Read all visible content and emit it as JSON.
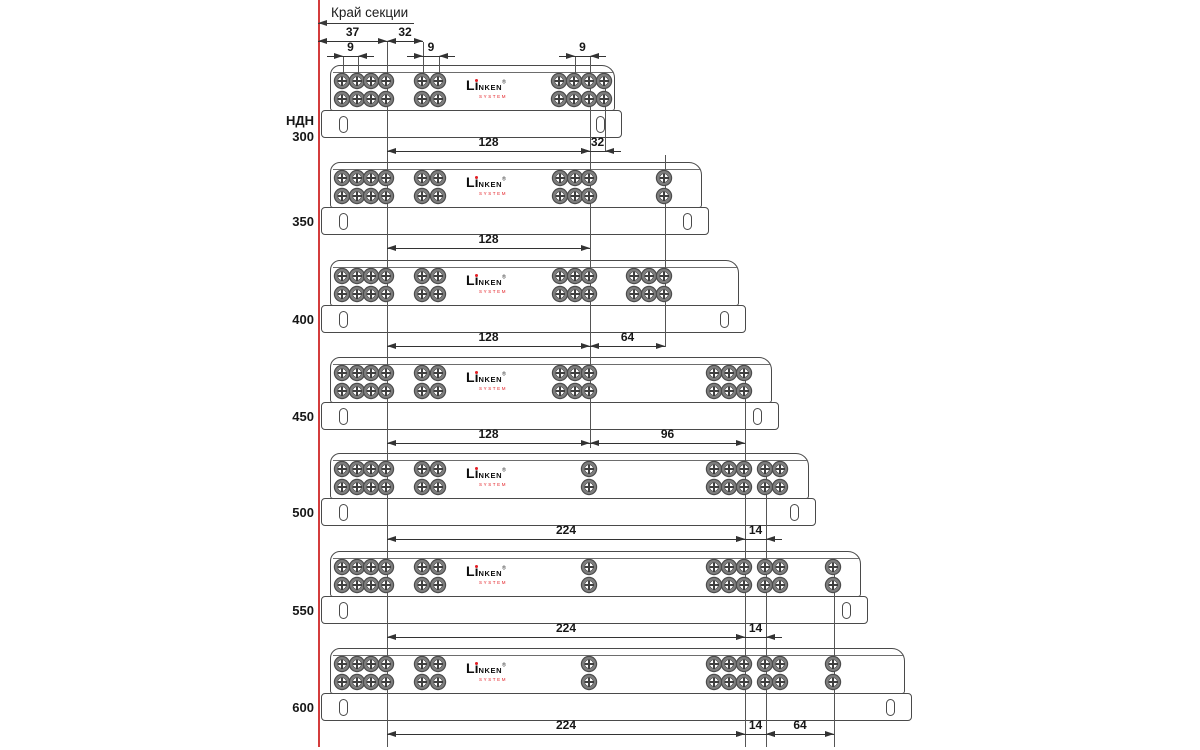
{
  "diagram": {
    "edge_section_label": "Край секции",
    "series_prefix": "НДН",
    "logo": {
      "l": "L",
      "i": "i",
      "rest": "NKEN",
      "reg": "®",
      "sub": "SYSTEM"
    },
    "colors": {
      "line": "#4a4a4a",
      "dim_line": "#333333",
      "text": "#171717",
      "guide_red": "#d43c3c",
      "logo_red": "#e31e24",
      "background": "#ffffff"
    },
    "guide_x": 318,
    "leader": {
      "y": 23,
      "x1": 318,
      "x2": 414
    },
    "top_dims": [
      {
        "label": "37",
        "x1": 318,
        "x2": 387,
        "y": 42
      },
      {
        "label": "32",
        "x1": 387,
        "x2": 423,
        "y": 42
      },
      {
        "label": "9",
        "x1": 343,
        "x2": 358,
        "y": 57,
        "outside": true
      },
      {
        "label": "9",
        "x1": 423,
        "x2": 439,
        "y": 57,
        "outside": true
      },
      {
        "label": "9",
        "x1": 575,
        "x2": 590,
        "y": 57,
        "outside": true
      }
    ],
    "construction_lines": [
      {
        "x": 387,
        "y1": 42,
        "y2": 747
      },
      {
        "x": 590,
        "y1": 57,
        "y2": 448
      },
      {
        "x": 665,
        "y1": 155,
        "y2": 347
      },
      {
        "x": 745,
        "y1": 368,
        "y2": 747
      },
      {
        "x": 766,
        "y1": 462,
        "y2": 747
      },
      {
        "x": 834,
        "y1": 560,
        "y2": 747
      }
    ],
    "extension_lines": [
      {
        "x": 343,
        "y1": 57,
        "y2": 80
      },
      {
        "x": 358,
        "y1": 57,
        "y2": 80
      },
      {
        "x": 423,
        "y1": 42,
        "y2": 80
      },
      {
        "x": 439,
        "y1": 57,
        "y2": 80
      },
      {
        "x": 575,
        "y1": 57,
        "y2": 80
      },
      {
        "x": 605,
        "y1": 78,
        "y2": 152
      }
    ],
    "slides": [
      {
        "size": "300",
        "show_prefix": true,
        "top": 65,
        "left": 330,
        "right": 616,
        "hole_cols": [
          343,
          358,
          372,
          387,
          423,
          439,
          560,
          575,
          590,
          605
        ],
        "dims": [
          {
            "label": "128",
            "x1": 387,
            "x2": 590
          },
          {
            "label": "32",
            "x1": 590,
            "x2": 605,
            "outside": true
          }
        ]
      },
      {
        "size": "350",
        "show_prefix": false,
        "top": 162,
        "left": 330,
        "right": 703,
        "hole_cols": [
          343,
          358,
          372,
          387,
          423,
          439,
          561,
          576,
          590,
          665
        ],
        "dims": [
          {
            "label": "128",
            "x1": 387,
            "x2": 590
          }
        ]
      },
      {
        "size": "400",
        "show_prefix": false,
        "top": 260,
        "left": 330,
        "right": 740,
        "hole_cols": [
          343,
          358,
          372,
          387,
          423,
          439,
          561,
          576,
          590,
          635,
          650,
          665
        ],
        "dims": [
          {
            "label": "128",
            "x1": 387,
            "x2": 590
          },
          {
            "label": "64",
            "x1": 590,
            "x2": 665
          }
        ]
      },
      {
        "size": "450",
        "show_prefix": false,
        "top": 357,
        "left": 330,
        "right": 773,
        "hole_cols": [
          343,
          358,
          372,
          387,
          423,
          439,
          561,
          576,
          590,
          715,
          730,
          745
        ],
        "dims": [
          {
            "label": "128",
            "x1": 387,
            "x2": 590
          },
          {
            "label": "96",
            "x1": 590,
            "x2": 745
          }
        ]
      },
      {
        "size": "500",
        "show_prefix": false,
        "top": 453,
        "left": 330,
        "right": 810,
        "hole_cols": [
          343,
          358,
          372,
          387,
          423,
          439,
          590,
          715,
          730,
          745,
          766,
          781
        ],
        "dims": [
          {
            "label": "224",
            "x1": 387,
            "x2": 745
          },
          {
            "label": "14",
            "x1": 745,
            "x2": 766,
            "outside": true
          }
        ]
      },
      {
        "size": "550",
        "show_prefix": false,
        "top": 551,
        "left": 330,
        "right": 862,
        "hole_cols": [
          343,
          358,
          372,
          387,
          423,
          439,
          590,
          715,
          730,
          745,
          766,
          781,
          834
        ],
        "dims": [
          {
            "label": "224",
            "x1": 387,
            "x2": 745
          },
          {
            "label": "14",
            "x1": 745,
            "x2": 766,
            "outside": true
          }
        ]
      },
      {
        "size": "600",
        "show_prefix": false,
        "top": 648,
        "left": 330,
        "right": 906,
        "hole_cols": [
          343,
          358,
          372,
          387,
          423,
          439,
          590,
          715,
          730,
          745,
          766,
          781,
          834
        ],
        "dims": [
          {
            "label": "224",
            "x1": 387,
            "x2": 745
          },
          {
            "label": "14",
            "x1": 745,
            "x2": 766,
            "outside": true
          },
          {
            "label": "64",
            "x1": 766,
            "x2": 834
          }
        ]
      }
    ]
  }
}
